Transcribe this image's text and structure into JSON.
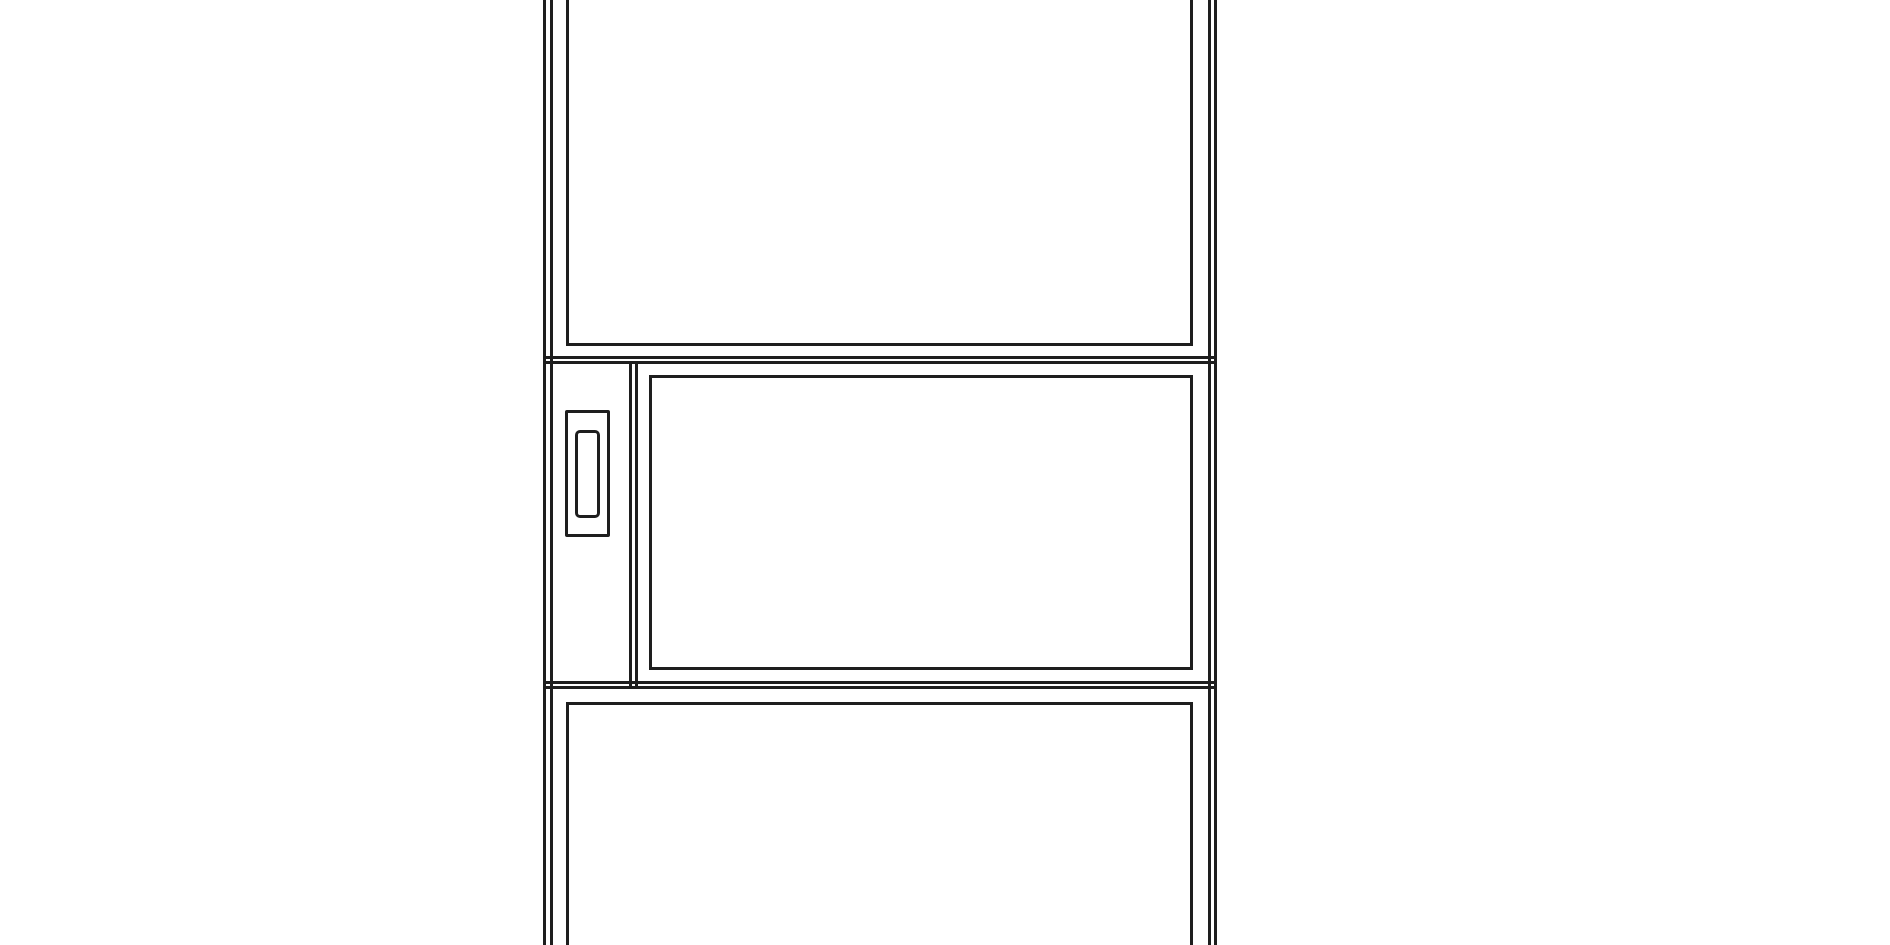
{
  "page": {
    "background_color": "#ffffff"
  },
  "drawing": {
    "description": "CAD-style front elevation line drawing of a tall cabinet: upper door panel, middle section with a left stile carrying a vertical pull handle beside a drawer/appliance front, and a lower door panel; drawing is cropped at top and bottom of the view",
    "stroke_color": "#1e1e1e",
    "stroke_thin_px": 3,
    "canvas": {
      "width": 1890,
      "height": 945
    },
    "shapes": [
      {
        "name": "cabinet-left-side-outer-line",
        "type": "vline",
        "x": 543,
        "y": 0,
        "w": 3,
        "h": 945
      },
      {
        "name": "cabinet-left-side-inner-line",
        "type": "vline",
        "x": 550,
        "y": 0,
        "w": 3,
        "h": 945
      },
      {
        "name": "cabinet-right-side-inner-line",
        "type": "vline",
        "x": 1208,
        "y": 0,
        "w": 3,
        "h": 945
      },
      {
        "name": "cabinet-right-side-outer-line",
        "type": "vline",
        "x": 1214,
        "y": 0,
        "w": 3,
        "h": 945
      },
      {
        "name": "upper-door-panel",
        "type": "rect",
        "x": 566,
        "y": -20,
        "w": 627,
        "h": 366,
        "r": 0
      },
      {
        "name": "upper-rail-line-top",
        "type": "hline",
        "x": 545,
        "y": 356,
        "w": 671,
        "h": 3
      },
      {
        "name": "upper-rail-line-bottom",
        "type": "hline",
        "x": 545,
        "y": 361,
        "w": 671,
        "h": 3
      },
      {
        "name": "middle-stile-line-left",
        "type": "vline",
        "x": 629,
        "y": 362,
        "w": 3,
        "h": 327
      },
      {
        "name": "middle-stile-line-right",
        "type": "vline",
        "x": 635,
        "y": 362,
        "w": 3,
        "h": 327
      },
      {
        "name": "pull-handle-outer",
        "type": "rect",
        "x": 565,
        "y": 410,
        "w": 45,
        "h": 127,
        "r": 2
      },
      {
        "name": "pull-handle-inner",
        "type": "rect",
        "x": 575,
        "y": 430,
        "w": 25,
        "h": 88,
        "r": 5
      },
      {
        "name": "middle-drawer-front",
        "type": "rect",
        "x": 649,
        "y": 375,
        "w": 544,
        "h": 295,
        "r": 0
      },
      {
        "name": "lower-rail-line-top",
        "type": "hline",
        "x": 545,
        "y": 681,
        "w": 671,
        "h": 3
      },
      {
        "name": "lower-rail-line-bottom",
        "type": "hline",
        "x": 545,
        "y": 686,
        "w": 671,
        "h": 3
      },
      {
        "name": "lower-door-panel",
        "type": "rect",
        "x": 566,
        "y": 702,
        "w": 627,
        "h": 283,
        "r": 0
      }
    ]
  }
}
